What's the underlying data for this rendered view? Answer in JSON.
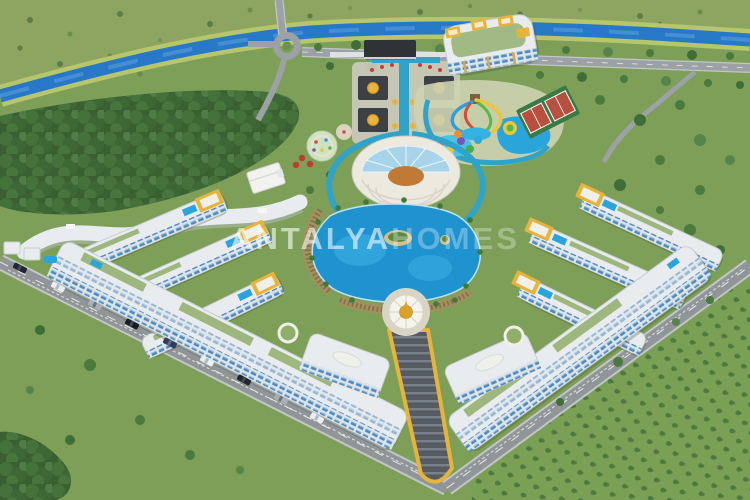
{
  "image": {
    "kind": "3d-aerial-architectural-render",
    "subject": "resort-style residential complex with central lagoon pool, aqua park, amphitheater and gardens beside a river"
  },
  "watermark": {
    "part1": "ANTALYA",
    "part2": "HOMES"
  },
  "colors": {
    "grass": "#7d9f58",
    "upper_field": "#8da560",
    "forest": "#3a5f31",
    "river": "#2878c8",
    "river_bank": "#b7c66b",
    "road": "#9ba1a4",
    "building": "#e9ecef",
    "windows": "#4f88bd",
    "gold_accent": "#e8b33b",
    "lagoon_pool": "#1f93cf",
    "canal": "#2fa3c8",
    "stairs": "#565b61",
    "dome_gold": "#d9a32a",
    "tennis_court": "#b8503f",
    "tennis_surround": "#3a7a44",
    "amphitheater_glass": "#a8d4ea",
    "stage_floor": "#c07a36",
    "plaza": "#d8d4c6",
    "gate_dark": "#2f3338"
  }
}
